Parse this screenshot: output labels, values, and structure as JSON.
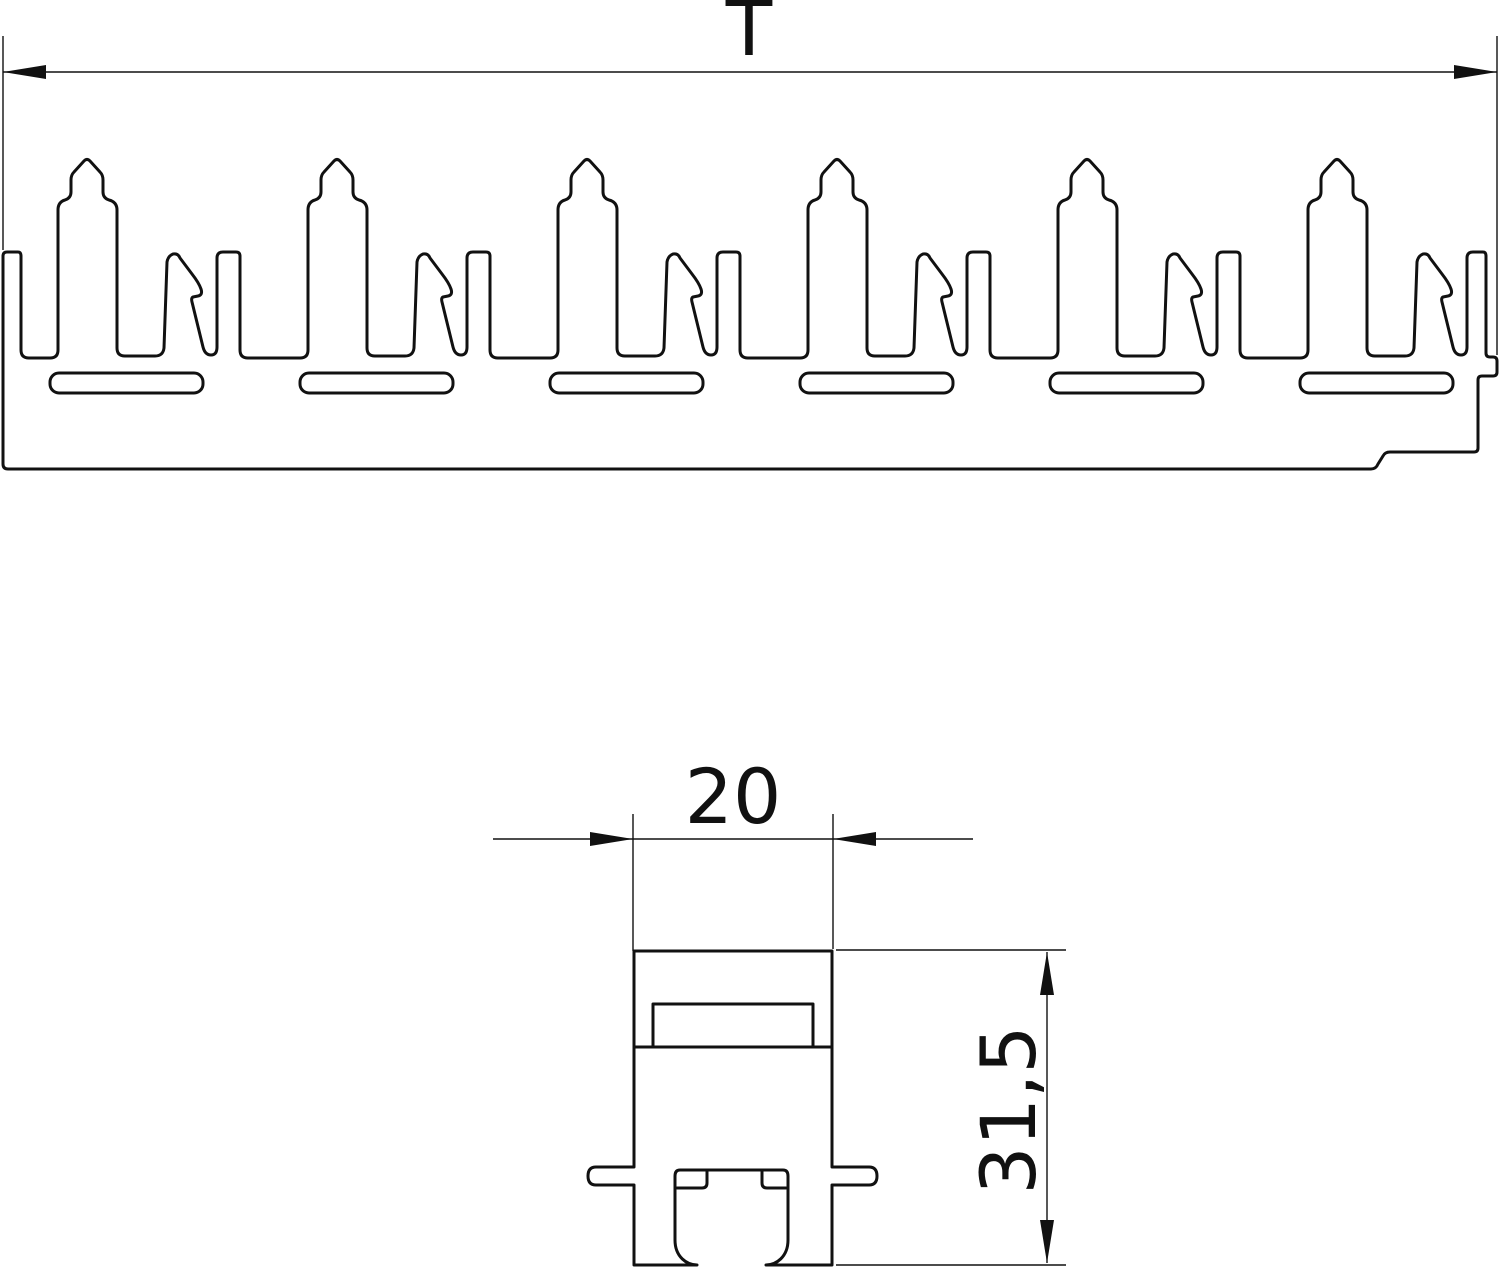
{
  "drawing": {
    "background_color": "#ffffff",
    "line_color": "#111111",
    "top_view": {
      "dimension_width_label": "T"
    },
    "bottom_view": {
      "dimension_width_label": "20",
      "dimension_height_label": "31,5"
    }
  }
}
